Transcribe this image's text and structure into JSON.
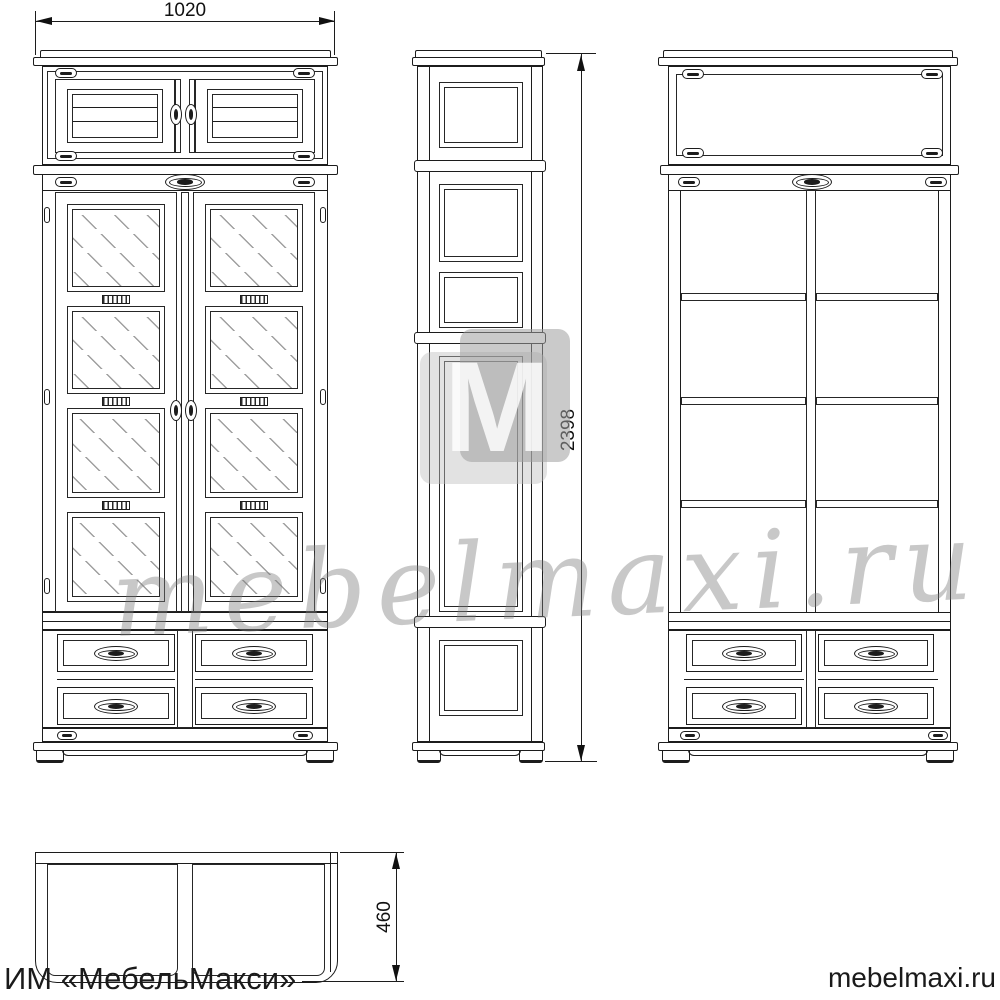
{
  "drawing": {
    "type": "furniture technical drawing, three orthographic views of a two-door display cabinet with drawers",
    "line_color": "#1c1c1c",
    "background": "#ffffff"
  },
  "dimensions": {
    "width": "1020",
    "height": "2398",
    "depth": "460"
  },
  "branding": {
    "footer_left": "ИМ «МебельМакси»",
    "footer_right": "mebelmaxi.ru",
    "watermark_script": "mebelmaxi.ru",
    "logo_letter": "M",
    "logo_light_color": "#e2e2e2",
    "logo_dark_color": "#c6c6c6",
    "watermark_gray": "#9e9e9e"
  },
  "views": {
    "front": {
      "top_doors": 2,
      "glass_doors": 2,
      "glass_panes_per_door": 4,
      "drawers": 4
    },
    "side": {
      "panels": 5
    },
    "interior": {
      "sections": 2,
      "shelves": 3,
      "drawers": 4
    },
    "top": {
      "compartments": 2
    }
  }
}
